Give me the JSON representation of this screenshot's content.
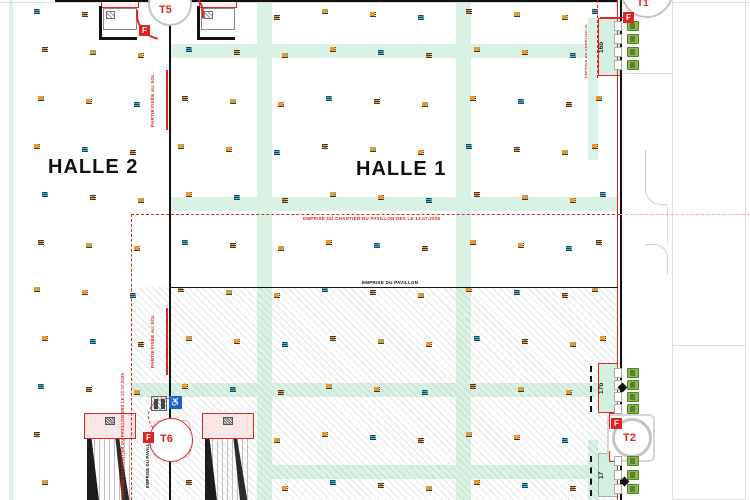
{
  "labels": {
    "halle1": "HALLE 1",
    "halle2": "HALLE 2"
  },
  "annotations": {
    "chantier": "EMPRISE DU CHANTIER DU PAVILLON DES LE 13.07.2026",
    "pavillon": "EMPRISE DU PAVILLON",
    "partie_fixee": "PARTIE FIXÉE AU SOL"
  },
  "cranes": {
    "badge": "F",
    "t5": {
      "label": "T5"
    },
    "t6": {
      "label": "T6"
    },
    "t1": {
      "label": "T1"
    },
    "t2": {
      "label": "T2"
    }
  },
  "rooms": {
    "r16b": "16b",
    "r17b": "17b",
    "r17": "17"
  },
  "icons": {
    "wheelchair": "♿"
  },
  "colors": {
    "aisle_mint": "#d9f2e3",
    "site_red": "#e0241f",
    "marker_cyan": "#31b8e9",
    "marker_orange": "#f7941d",
    "door_green": "#8ab84e",
    "wall_black": "#111111"
  },
  "marker_grid": {
    "cols": [
      38,
      86,
      134,
      182,
      230,
      278,
      326,
      374,
      422,
      470,
      518,
      566,
      596
    ],
    "rows": [
      10,
      48,
      97,
      145,
      193,
      241,
      288,
      337,
      385,
      433,
      481
    ],
    "skip": [
      [
        0,
        2
      ],
      [
        0,
        3
      ],
      [
        0,
        4
      ],
      [
        1,
        12
      ],
      [
        8,
        12
      ],
      [
        9,
        12
      ],
      [
        10,
        12
      ],
      [
        9,
        1
      ],
      [
        9,
        2
      ],
      [
        9,
        3
      ],
      [
        9,
        4
      ],
      [
        10,
        1
      ],
      [
        10,
        2
      ],
      [
        10,
        4
      ]
    ]
  },
  "doors": {
    "groups": [
      {
        "x": 627,
        "y": 21,
        "count": 4,
        "gap": 13
      },
      {
        "x": 627,
        "y": 368,
        "count": 4,
        "gap": 12
      },
      {
        "x": 627,
        "y": 456,
        "count": 3,
        "gap": 14
      }
    ]
  }
}
